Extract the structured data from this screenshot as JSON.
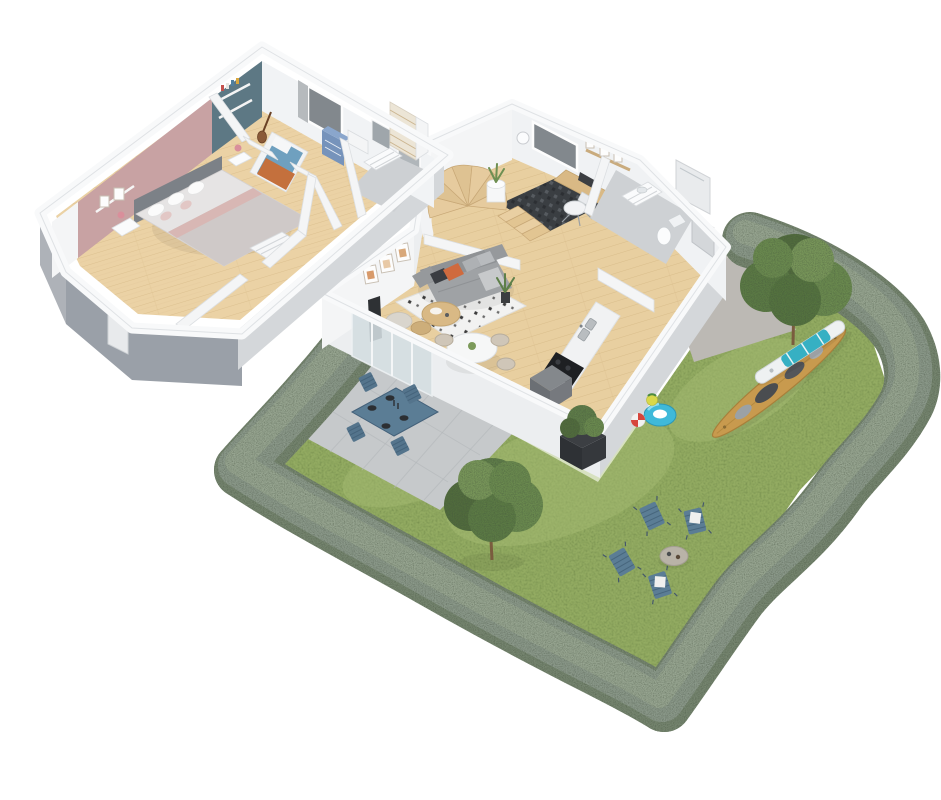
{
  "meta": {
    "description": "3D isometric cutaway floor plan render of a two-storey house with garden",
    "view": "axonometric cutaway",
    "background": "#ffffff"
  },
  "palette": {
    "lawn": "#93ab62",
    "lawn_light": "#a7bd74",
    "hedge_dark": "#76856f",
    "hedge": "#8b998a",
    "hedge_light": "#9aa893",
    "patio": "#c6c9cb",
    "path": "#bcb9b4",
    "wood_upper": "#ebd2a5",
    "wood_upper_line": "#dcc08f",
    "wood_ground": "#e8cfa0",
    "wood_ground_line": "#d9bd8b",
    "wall_white": "#f4f5f6",
    "wall_light": "#eceef0",
    "wall_outer_dark": "#9aa0a8",
    "wall_outer_mid": "#d4d7da",
    "master_wall_pink": "#c8a2a3",
    "kids_wall_teal": "#5d7884",
    "sofa_gray": "#9fa2a5",
    "cushion_orange": "#cf6a3e",
    "cushion_dark": "#3a3d42",
    "kayak_tan": "#c89a4e",
    "board_teal": "#36b0c3",
    "outdoor_blue": "#5b7d95",
    "tree_green": "#5f7d48",
    "tree_green_dark": "#516c3e",
    "planter_dark": "#3c3f43",
    "swim_ring_blue": "#3fb9d9",
    "cooktop_black": "#1e2023",
    "stairs_wood": "#e2c592",
    "rug_white": "#f2f2f1",
    "office_rug_dark": "#3a3e42",
    "glass": "#d3dde1",
    "window_dark": "#82888d",
    "dresser_blue": "#7693bb",
    "mattress_blue": "#6fa0bf",
    "blanket_orange": "#c4703d",
    "table_wood": "#d9b985",
    "stone_table": "#b9b3a8",
    "headboard_gray": "#7c8187"
  },
  "floors": {
    "upper": {
      "name": "upper-floor",
      "rooms": [
        {
          "name": "master-bedroom",
          "accent_wall": "#c8a2a3",
          "furniture": [
            "double-bed",
            "gray-headboard",
            "nightstands",
            "white-dresser",
            "wall-shelf",
            "picture-frames"
          ]
        },
        {
          "name": "kids-bedroom",
          "accent_wall": "#5d7884",
          "furniture": [
            "single-bed",
            "blue-dresser",
            "white-desk",
            "guitar",
            "wall-shelves",
            "window"
          ]
        },
        {
          "name": "bathroom",
          "furniture": [
            "vanity",
            "mirror",
            "shower"
          ]
        },
        {
          "name": "hallway"
        },
        {
          "name": "staircase"
        }
      ]
    },
    "ground": {
      "name": "ground-floor",
      "rooms": [
        {
          "name": "living-room",
          "furniture": [
            "sofa",
            "coffee-tables",
            "patterned-rug",
            "pouf",
            "floor-lamp",
            "picture-frames",
            "plant"
          ]
        },
        {
          "name": "dining-area",
          "furniture": [
            "round-table",
            "chairs"
          ]
        },
        {
          "name": "kitchen",
          "furniture": [
            "counter",
            "sink",
            "cooktop",
            "gray-unit",
            "half-wall-window"
          ]
        },
        {
          "name": "office-nook",
          "furniture": [
            "desk",
            "office-chair",
            "dark-rug",
            "window",
            "shelf",
            "pendant-lamp"
          ]
        },
        {
          "name": "bathroom",
          "furniture": [
            "vanity",
            "toilet",
            "shower"
          ]
        },
        {
          "name": "entry",
          "furniture": [
            "front-door"
          ]
        },
        {
          "name": "spiral-staircase",
          "furniture": [
            "curved-parapet",
            "plant-pedestal"
          ]
        }
      ]
    }
  },
  "garden": {
    "features": [
      "lawn",
      "hedge-border",
      "patio-terrace",
      "concrete-path"
    ],
    "items": [
      {
        "name": "tree",
        "count": 2
      },
      {
        "name": "outdoor-dining-set",
        "seats": 4,
        "color": "#5b7d95"
      },
      {
        "name": "lounge-chair",
        "count": 4,
        "color": "#5b7d95"
      },
      {
        "name": "stone-fire-table",
        "color": "#b9b3a8"
      },
      {
        "name": "kayak",
        "color": "#c89a4e"
      },
      {
        "name": "paddleboard",
        "colors": [
          "#eef1f2",
          "#36b0c3"
        ]
      },
      {
        "name": "swim-ring",
        "color": "#3fb9d9"
      },
      {
        "name": "beach-ball",
        "count": 2
      },
      {
        "name": "planter-box",
        "color": "#3c3f43"
      }
    ]
  }
}
